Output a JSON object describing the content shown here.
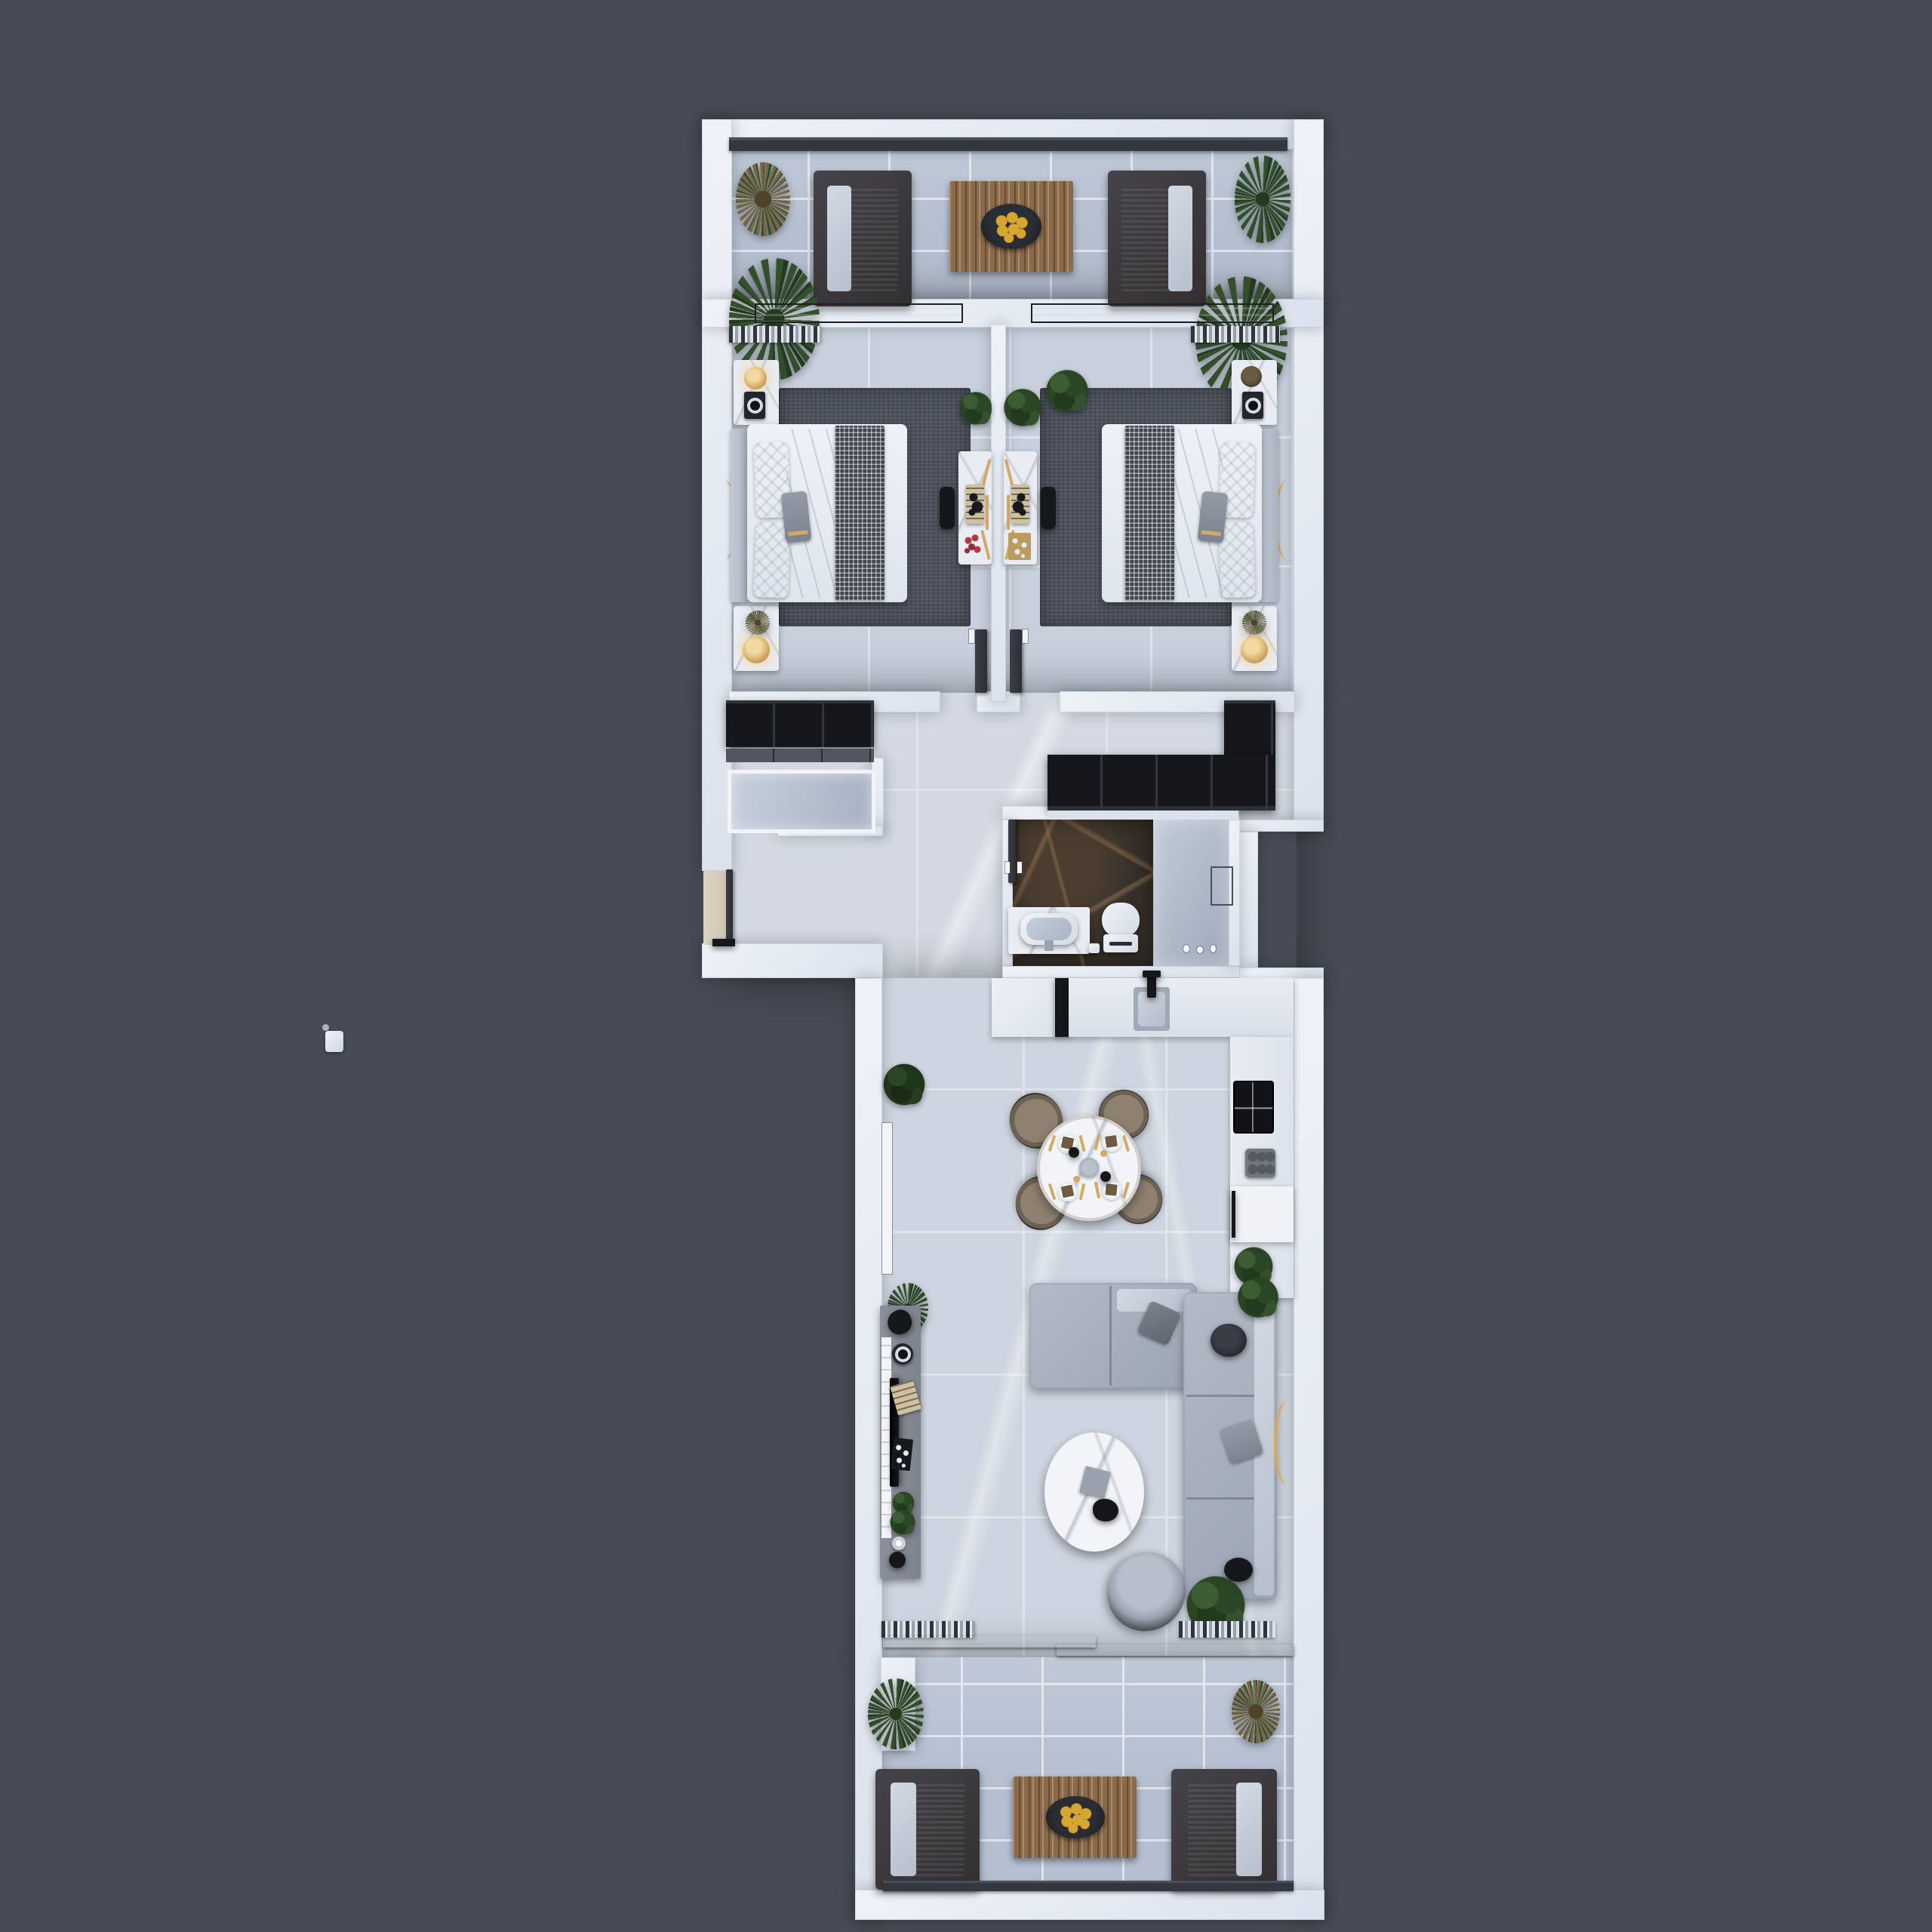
{
  "scene": {
    "description": "Top-down 3D render of a one-storey apartment floor plan on a dark slate background",
    "view": "top-down-floorplan",
    "visible_text": "none"
  },
  "palette": {
    "bg": "#474b55",
    "wall": "#eef2f8",
    "wallShade": "#dbe2ed",
    "railing": "#33373f",
    "doorDark": "#2c2f37",
    "floorBalcony": "#b5bfd0",
    "floorBedroom": "#c8d0dd",
    "floorHall": "#d3d8e2",
    "floorMain": "#ced5e0",
    "grout": "#dfe4ec",
    "rug": "#4d525d",
    "blanket": "#3e434e",
    "marble": "#e9ecf2",
    "white": "#f2f4f8",
    "black": "#15171b",
    "drawer": "#51565f",
    "gold": "#d4a964",
    "goldGlow": "#f3d8a2",
    "wood": "#8a6a49",
    "fruit": "#d7a630",
    "bowl": "#17191d",
    "plant": "#33502d",
    "plantDark": "#233a1e",
    "plantBrown": "#7a6647",
    "sofa": "#9ba4b2",
    "sofaLight": "#b2bac7",
    "tan": "#8e8171",
    "tvConsole": "#7e838e",
    "cooktop": "#111318",
    "grill": "#70757e",
    "bathFloor": "#362f29"
  },
  "rooms": [
    {
      "name": "top-terrace",
      "furniture": [
        "lounge-sofa-left",
        "lounge-sofa-right",
        "wood-slat-table",
        "fruit-bowl",
        "glass-railing",
        "plants-x4"
      ]
    },
    {
      "name": "bedroom-left",
      "furniture": [
        "double-bed",
        "checkered-throw",
        "headboard",
        "nightstand-x2",
        "gold-lamp-x2",
        "speaker",
        "rug",
        "vanity-desk",
        "vanity-chair",
        "arc-floor-lamp",
        "window-curtain",
        "swing-door",
        "plants"
      ]
    },
    {
      "name": "bedroom-right",
      "furniture": [
        "double-bed",
        "checkered-throw",
        "headboard",
        "nightstand-x2",
        "gold-lamp",
        "speaker",
        "decor-bowl",
        "rug",
        "vanity-desk",
        "vanity-chair",
        "arc-floor-lamp",
        "window-curtain",
        "swing-door",
        "plants"
      ]
    },
    {
      "name": "hallway",
      "furniture": [
        "black-wardrobe-left",
        "drawer-unit",
        "glass-closet",
        "black-wardrobe-right",
        "entrance-door",
        "entry-mat"
      ]
    },
    {
      "name": "bathroom",
      "furniture": [
        "sink-vanity",
        "basin",
        "toilet",
        "shower-enclosure",
        "glass-door",
        "swing-door",
        "bin",
        "accessories"
      ]
    },
    {
      "name": "kitchen",
      "furniture": [
        "upper-counter",
        "sink",
        "black-faucet",
        "side-counter",
        "induction-cooktop",
        "grill-pan",
        "dishwasher",
        "plant"
      ]
    },
    {
      "name": "dining",
      "furniture": [
        "round-marble-table",
        "dining-chair-x4",
        "place-setting-x4",
        "center-decor"
      ]
    },
    {
      "name": "living-room",
      "furniture": [
        "l-shaped-sofa",
        "throw-pillows",
        "round-coffee-table",
        "tv-console",
        "wall-tv",
        "decor-books",
        "armchair",
        "black-side-table",
        "gold-floor-lamp",
        "plants",
        "sliding-glass-door",
        "curtains"
      ]
    },
    {
      "name": "bottom-terrace",
      "furniture": [
        "lounge-sofa-left",
        "lounge-sofa-right",
        "wood-slat-table",
        "fruit-bowl",
        "railing",
        "plants-x2"
      ]
    }
  ],
  "misc": {
    "detached_object": "small white object floating at far left of canvas"
  }
}
